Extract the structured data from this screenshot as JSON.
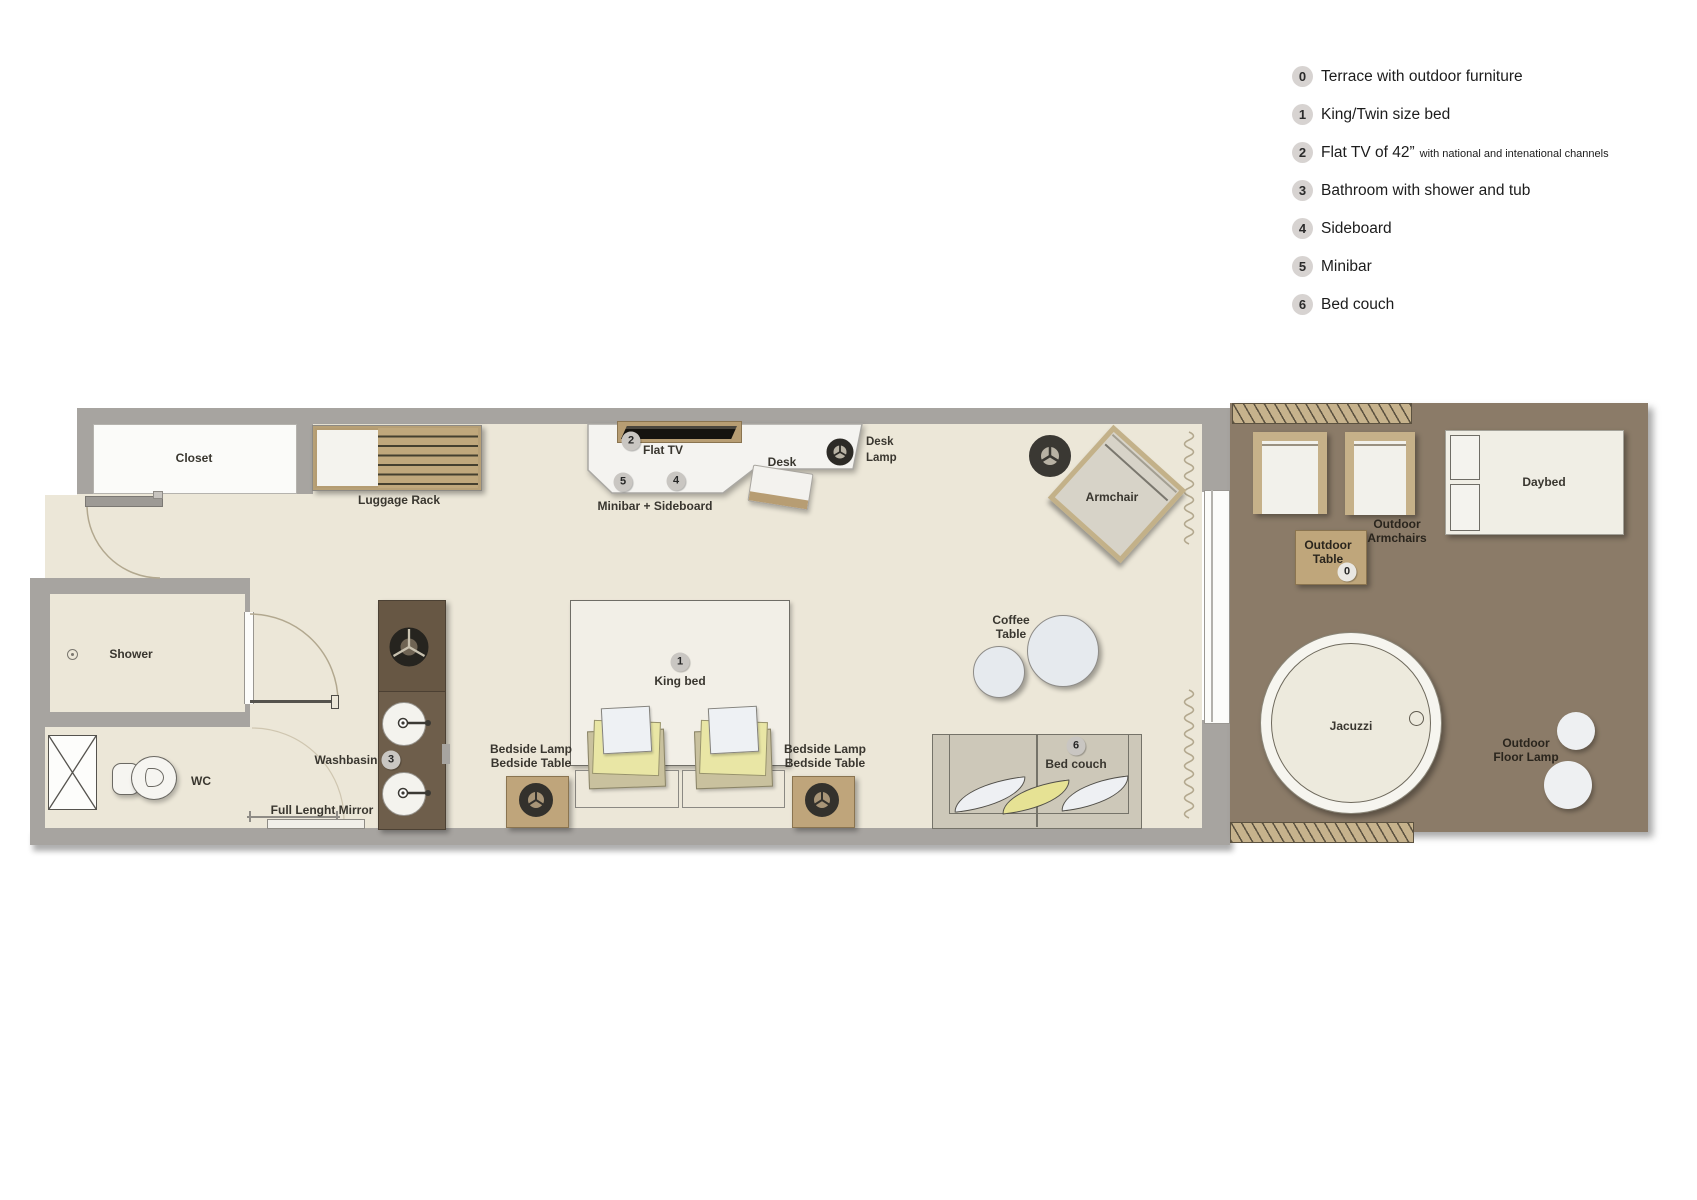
{
  "colors": {
    "floor": "#ece7d8",
    "wall": "#a7a4a0",
    "terrace_floor": "#8b7b68",
    "wood_tan": "#c0a87c",
    "vanity_brown": "#675744",
    "pillow_yellow": "#e6e294",
    "unit_white": "#f4f3f0"
  },
  "legend": {
    "items": [
      {
        "num": "0",
        "label": "Terrace with outdoor furniture",
        "suffix": ""
      },
      {
        "num": "1",
        "label": "King/Twin size bed",
        "suffix": ""
      },
      {
        "num": "2",
        "label": "Flat TV of 42”",
        "suffix": "with national and intenational channels"
      },
      {
        "num": "3",
        "label": "Bathroom with shower and tub",
        "suffix": ""
      },
      {
        "num": "4",
        "label": "Sideboard",
        "suffix": ""
      },
      {
        "num": "5",
        "label": "Minibar",
        "suffix": ""
      },
      {
        "num": "6",
        "label": "Bed couch",
        "suffix": ""
      }
    ]
  },
  "plan": {
    "closet": "Closet",
    "luggage_rack": "Luggage Rack",
    "shower": "Shower",
    "wc": "WC",
    "washbasin": "Washbasin",
    "mirror": "Full Lenght Mirror",
    "flat_tv": "Flat TV",
    "minibar_sideboard": "Minibar + Sideboard",
    "desk": "Desk",
    "desk_lamp_l1": "Desk",
    "desk_lamp_l2": "Lamp",
    "armchair": "Armchair",
    "king_bed": "King bed",
    "bedside_lamp": "Bedside Lamp",
    "bedside_table": "Bedside Table",
    "coffee_l1": "Coffee",
    "coffee_l2": "Table",
    "bed_couch": "Bed couch",
    "outdoor_armchairs_l1": "Outdoor",
    "outdoor_armchairs_l2": "Armchairs",
    "outdoor_table_l1": "Outdoor",
    "outdoor_table_l2": "Table",
    "daybed": "Daybed",
    "jacuzzi": "Jacuzzi",
    "outdoor_lamp_l1": "Outdoor",
    "outdoor_lamp_l2": "Floor Lamp"
  },
  "badges": {
    "terrace": "0",
    "bed": "1",
    "tv": "2",
    "bath": "3",
    "sideboard": "4",
    "minibar": "5",
    "couch": "6"
  }
}
